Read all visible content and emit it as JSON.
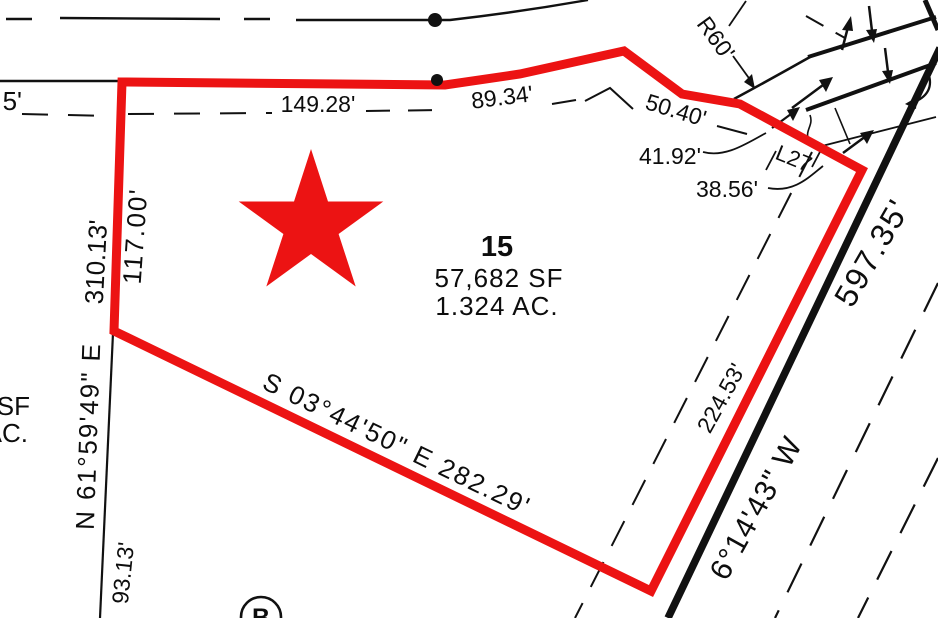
{
  "colors": {
    "boundary_red": "#ec1313",
    "ink_black": "#111111"
  },
  "lot": {
    "number": "15",
    "area_sf": "57,682 SF",
    "area_ac": "1.324 AC."
  },
  "dimensions": {
    "top_partial": "5'",
    "top_1": "149.28'",
    "top_2": "89.34'",
    "top_3": "50.40'",
    "top_4": "41.92'",
    "top_5": "38.56'",
    "left_inner": "117.00'",
    "left_outer": "310.13'",
    "left_lower": "93.13'",
    "road_frontage": "224.53'"
  },
  "bearings": {
    "left_line": "N 61°59'49\" E",
    "bottom_line": "S 03°44'50\" E  282.29'",
    "road_line": "6°14'43\" W"
  },
  "road": {
    "length": "597.35'"
  },
  "curve_labels": {
    "radius": "R60'",
    "segment_id": "L27"
  },
  "adjacent_lot": {
    "sf_suffix": "SF",
    "ac_suffix": "AC."
  },
  "markers": {
    "point_id": "B"
  }
}
